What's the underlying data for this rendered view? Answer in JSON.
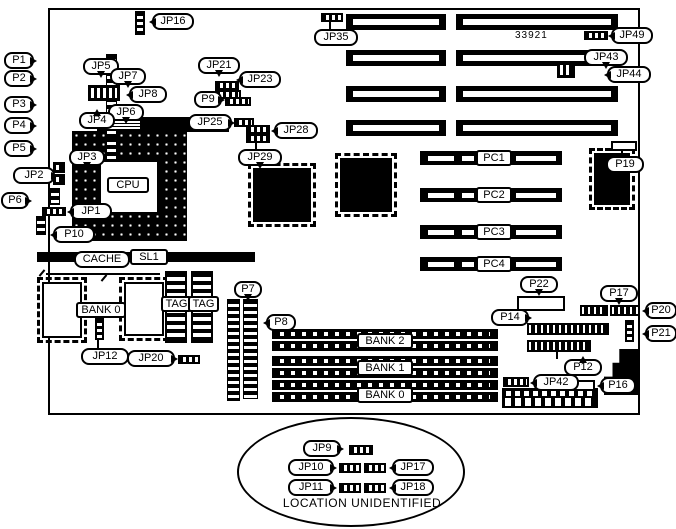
{
  "diagram": {
    "part_number": "33921",
    "location_note": "LOCATION UNIDENTIFIED"
  },
  "callouts": {
    "jp16": "JP16",
    "jp35": "JP35",
    "jp49": "JP49",
    "jp43": "JP43",
    "jp44": "JP44",
    "jp21": "JP21",
    "jp23": "JP23",
    "p9": "P9",
    "jp25": "JP25",
    "jp28": "JP28",
    "jp29": "JP29",
    "p1": "P1",
    "p2": "P2",
    "p3": "P3",
    "p4": "P4",
    "p5": "P5",
    "jp5": "JP5",
    "jp7": "JP7",
    "jp8": "JP8",
    "jp6": "JP6",
    "jp4": "JP4",
    "jp3": "JP3",
    "jp2": "JP2",
    "p6": "P6",
    "jp1": "JP1",
    "p10": "P10",
    "p19": "P19",
    "p22": "P22",
    "p14": "P14",
    "p17": "P17",
    "p20": "P20",
    "p21": "P21",
    "p12": "P12",
    "jp42": "JP42",
    "p16": "P16",
    "jp12": "JP12",
    "jp20": "JP20",
    "p7": "P7",
    "p8": "P8",
    "jp9": "JP9",
    "jp10": "JP10",
    "jp11": "JP11",
    "jp17": "JP17",
    "jp18": "JP18"
  },
  "components": {
    "cpu": "CPU",
    "cache": "CACHE",
    "sl1": "SL1",
    "cache_bank": "BANK 0",
    "tag1": "TAG",
    "tag2": "TAG"
  },
  "slots": {
    "pci": [
      "PC1",
      "PC2",
      "PC3",
      "PC4"
    ],
    "memory_banks": [
      "BANK 2",
      "BANK 1",
      "BANK 0"
    ]
  }
}
